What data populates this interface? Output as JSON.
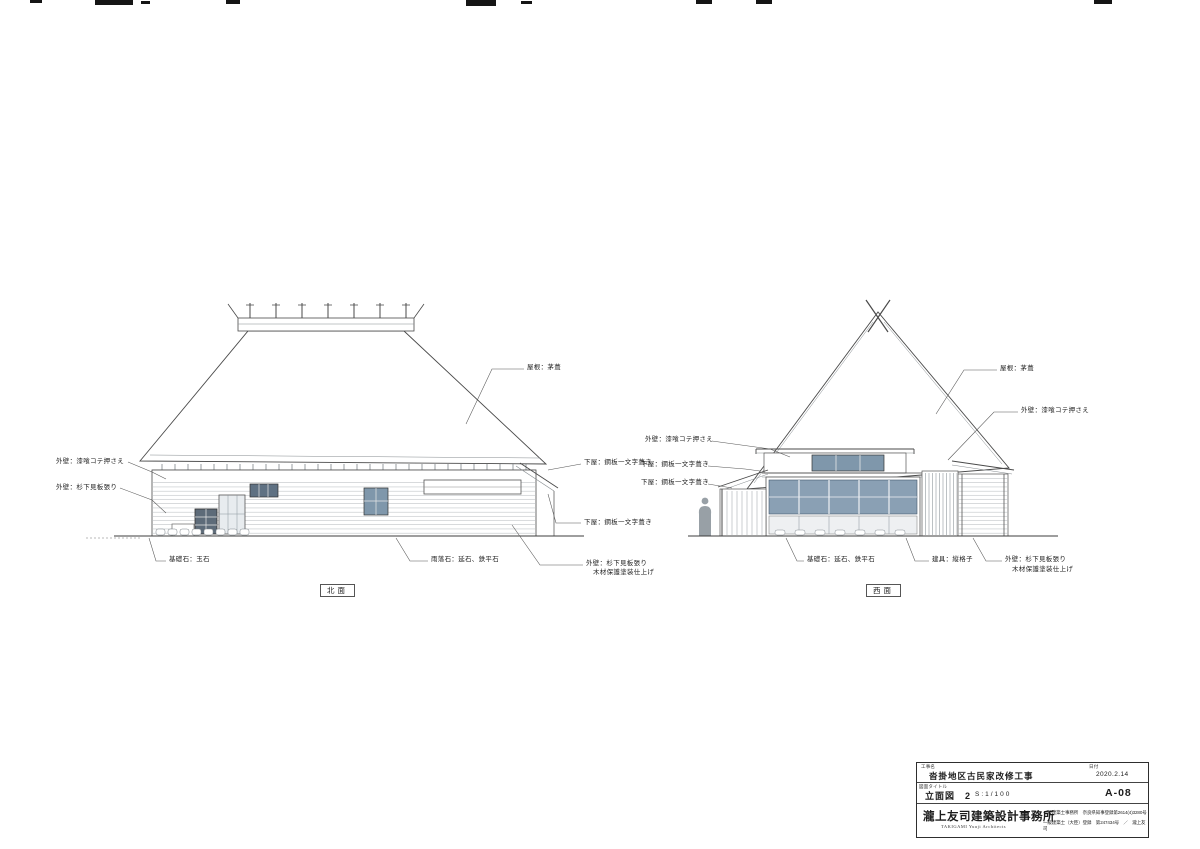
{
  "sheet": {
    "line_color": "#4a4a4a",
    "glass_color": "#8aa0b4",
    "dark_glass_color": "#5f7183"
  },
  "north_elevation": {
    "view_label": "北面",
    "labels": {
      "wall_plaster": "外壁：漆喰コテ押さえ",
      "wall_cedar": "外壁：杉下見板張り",
      "roof_thatch": "屋根：茅葺",
      "pent_roof_upper": "下屋：鋼板一文字葺き",
      "pent_roof_lower": "下屋：鋼板一文字葺き",
      "wall_cedar_paint_1": "外壁：杉下見板張り",
      "wall_cedar_paint_2": "木材保護塗装仕上げ",
      "foundation": "基礎石：玉石",
      "rain_stone": "雨落石：延石、鉄平石"
    }
  },
  "west_elevation": {
    "view_label": "西面",
    "labels": {
      "wall_plaster_left": "外壁：漆喰コテ押さえ",
      "pent_roof_1": "下屋：鋼板一文字葺き",
      "pent_roof_2": "下屋：鋼板一文字葺き",
      "roof_thatch": "屋根：茅葺",
      "wall_plaster_right": "外壁：漆喰コテ押さえ",
      "foundation": "基礎石：延石、鉄平石",
      "fitting": "建具：縦格子",
      "wall_cedar_paint_1": "外壁：杉下見板張り",
      "wall_cedar_paint_2": "木材保護塗装仕上げ"
    }
  },
  "title_block": {
    "project_label": "工事名",
    "project_name": "沓掛地区古民家改修工事",
    "date_label": "日付",
    "date": "2020.2.14",
    "drawing_title_label": "図面タイトル",
    "drawing_title": "立面図　2",
    "scale": "S:1/100",
    "drawing_number": "A-08",
    "firm_name": "瀧上友司建築設計事務所",
    "firm_name_en": "TAKIGAMI Yuuji Architects",
    "registration_line1": "一級建築士事務所　奈良県知事登録第2614(4)3280号",
    "registration_line2": "一級建築士（大臣）登録　第247434号　／　瀧上友司"
  }
}
